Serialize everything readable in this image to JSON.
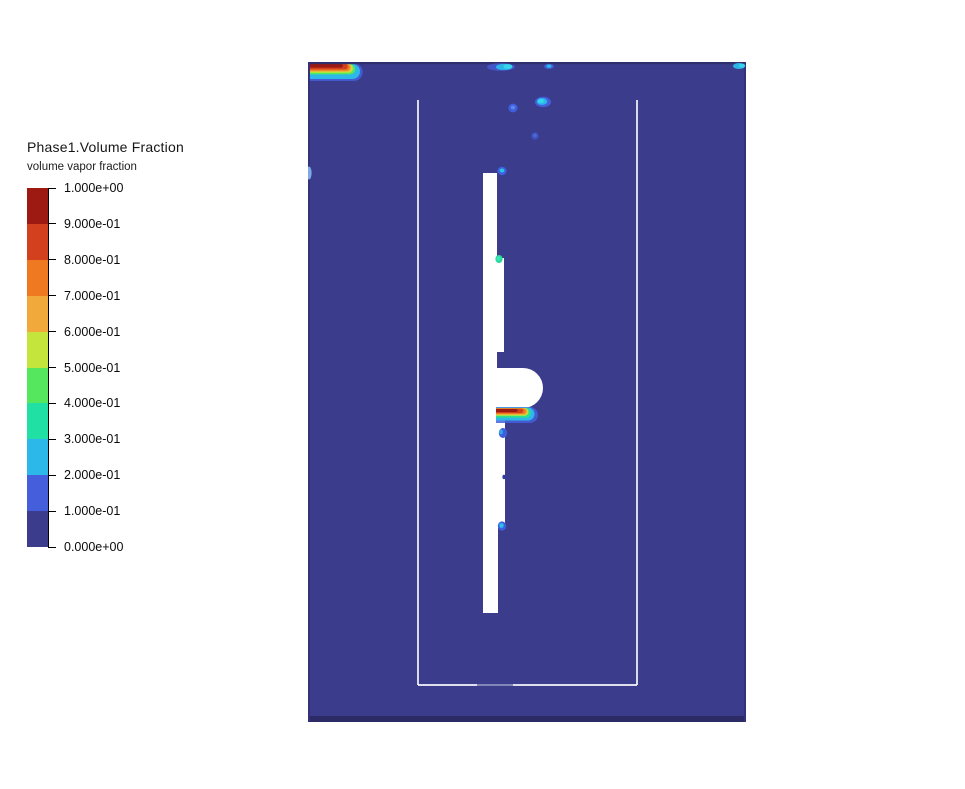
{
  "page": {
    "background": "#ffffff"
  },
  "legend": {
    "title": "Phase1.Volume Fraction",
    "subtitle": "volume vapor fraction",
    "ticks": [
      "1.000e+00",
      "9.000e-01",
      "8.000e-01",
      "7.000e-01",
      "6.000e-01",
      "5.000e-01",
      "4.000e-01",
      "3.000e-01",
      "2.000e-01",
      "1.000e-01",
      "0.000e+00"
    ],
    "band_colors_top_to_bottom": [
      "#9c1a11",
      "#d2401e",
      "#ee7920",
      "#f1a93c",
      "#c4e53c",
      "#55e85f",
      "#20e0a4",
      "#2cb9e9",
      "#455fdc",
      "#3b3c8c"
    ]
  },
  "colors": {
    "domain_background": "#3b3c8c",
    "domain_edge": "#312e6e",
    "solid_geometry": "#ffffff",
    "vapor_max": "#9c1a11",
    "bubble_blue": "#3f5ede",
    "bubble_cyan": "#2cb9e9"
  },
  "chart_data": {
    "type": "heatmap",
    "title": "Phase1.Volume Fraction",
    "subtitle": "volume vapor fraction",
    "variable": "volume vapor fraction",
    "levels": [
      0.0,
      0.1,
      0.2,
      0.3,
      0.4,
      0.5,
      0.6,
      0.7,
      0.8,
      0.9,
      1.0
    ],
    "level_labels_high_to_low": [
      "1.000e+00",
      "9.000e-01",
      "8.000e-01",
      "7.000e-01",
      "6.000e-01",
      "5.000e-01",
      "4.000e-01",
      "3.000e-01",
      "2.000e-01",
      "1.000e-01",
      "0.000e+00"
    ],
    "band_colors_low_to_high": [
      "#3b3c8c",
      "#455fdc",
      "#2cb9e9",
      "#20e0a4",
      "#55e85f",
      "#c4e53c",
      "#f1a93c",
      "#ee7920",
      "#d2401e",
      "#9c1a11"
    ],
    "legend_position": "left",
    "colormap": "rainbow, 10 discrete bands",
    "annotations": [
      {
        "feature": "bulk liquid field",
        "value_range": "0.0 - 0.1",
        "note": "dark indigo fill over nearly the whole rectangular tank"
      },
      {
        "feature": "vapor layer at top-left wall",
        "value_range": "0.1 - 1.0",
        "note": "thin horizontal tongue hugging the top wall at the left corner; dark-red core (~1.0) wrapped by orange, yellow, green, cyan and blue fringes"
      },
      {
        "feature": "vapor pocket under rounded protrusion",
        "value_range": "0.1 - 1.0",
        "note": "red streak (~1.0) directly beneath the mid-height rounded bulge of the internal rod, with rainbow fringe trailing right"
      },
      {
        "feature": "small detached bubbles",
        "value_range": "0.1 - 0.3",
        "note": "blue/cyan spots near the top wall (left-center, center, top-right corner), in the upper interior, on the left wall, and along the right edge of the internal rod"
      },
      {
        "feature": "white regions",
        "note": "solid internal geometry (vessel liner outline and center rod with bulge) - no field data"
      }
    ]
  }
}
